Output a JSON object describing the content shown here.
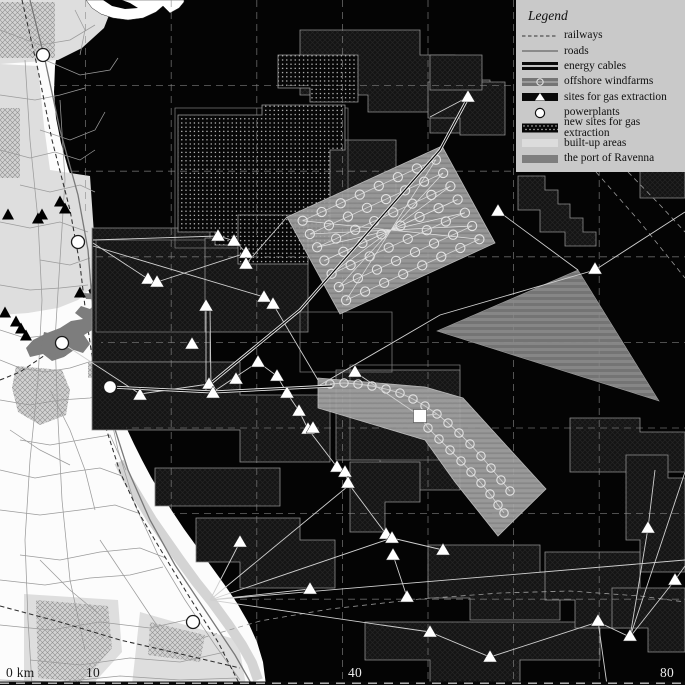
{
  "title": "Map of the Ravenna coast and offshore energy infrastructure",
  "colors": {
    "sea": "#040404",
    "land": "#fcfcfc",
    "builtup": "#dedede",
    "port": "#7d7d7d",
    "legend_bg": "#c9c9c9",
    "marker_white": "#ffffff",
    "concession_stroke": "#8e8e8e",
    "grid": "#8a8a8a",
    "road": "#9b9b9b",
    "railway": "#2e2e2e",
    "cable": "#d0d0d0",
    "scale_dark": "#1d1d1d",
    "scale_light": "#ececec"
  },
  "legend": {
    "title": "Legend",
    "x": 516,
    "y": 0,
    "width": 169,
    "height": 172,
    "items": [
      {
        "id": "railways",
        "symbol": "railway-line",
        "label": "railways"
      },
      {
        "id": "roads",
        "symbol": "road-line",
        "label": "roads"
      },
      {
        "id": "energy-cables",
        "symbol": "cable-swatch",
        "label": "energy cables"
      },
      {
        "id": "offshore-windfarms",
        "symbol": "windfarm-swatch",
        "label": "offshore windfarms"
      },
      {
        "id": "gas-sites",
        "symbol": "gas-swatch",
        "label": "sites for gas extraction"
      },
      {
        "id": "powerplants",
        "symbol": "powerplant-circle",
        "label": "powerplants"
      },
      {
        "id": "new-gas-sites",
        "symbol": "newgas-swatch",
        "label": "new sites for gas extraction"
      },
      {
        "id": "built-up",
        "symbol": "builtup-swatch",
        "label": "built-up areas"
      },
      {
        "id": "port-ravenna",
        "symbol": "port-swatch",
        "label": "the port of Ravenna"
      }
    ]
  },
  "scale": {
    "labels": [
      {
        "text": "0 km",
        "x": 6,
        "y": 665,
        "tone": "dark"
      },
      {
        "text": "10",
        "x": 86,
        "y": 665,
        "tone": "dark"
      },
      {
        "text": "40",
        "x": 348,
        "y": 665,
        "tone": "light"
      },
      {
        "text": "80",
        "x": 660,
        "y": 665,
        "tone": "light"
      }
    ]
  },
  "map": {
    "grid_spacing": 85.6,
    "coast": "75,0 66,20 59,42 55,66 54,92 56,118 61,143 68,168 77,193 86,215 92,233 94,246 91,262 88,276 88,289 92,300 96,312 99,326 101,342 104,360 108,377 113,393 119,410 126,427 134,444 142,460 151,477 161,494 172,511 184,529 197,547 211,566 224,584 237,603 248,622 257,642 263,662 266,685",
    "peninsula": "86,0 92,8 101,14 113,18 128,20 143,18 156,12 163,6 170,13 179,8 184,2 184,0",
    "peninsula_notch": "103,0 112,6 125,9 138,8 130,3 122,0",
    "builtup": [
      "0,0 115,0 104,28 82,48 58,60 0,64",
      "0,64 38,66 44,126 50,170 90,176 94,234 96,262 91,288 78,300 58,308 28,313 0,315",
      "24,594 118,600 122,652 92,685 24,685",
      "140,612 238,640 246,685 132,685"
    ],
    "builtup_coast_strip": "119,462 128,480 140,500 152,520 166,540 180,560 196,582 212,602 228,624 242,645 252,663 258,680",
    "cityhatch": [
      "0,2 55,2 55,58 0,58",
      "0,108 20,108 20,178 0,178",
      "16,366 62,370 70,390 66,415 40,425 18,412 12,388",
      "36,600 108,606 112,648 82,682 38,678",
      "88,362 112,362 112,378 88,378",
      "118,359 138,359 138,373 118,373",
      "150,622 205,635 200,662 148,655"
    ],
    "port": [
      "109,294 97,302 90,309 81,306 75,313 83,319 71,321 60,328 47,333 33,340 26,348 30,357 43,354 52,361 64,357 74,350 83,353 90,344 84,335 94,329 100,320 105,311 111,303",
      "44,332 70,338 66,356 40,352",
      "84,293 112,295 112,300 86,299"
    ],
    "roads_main": "30,0 45,60 60,130 78,195 88,250 92,300 100,360 112,420 128,470 150,520 175,565 205,610 235,655 252,685",
    "roads": [
      "0,30 40,45 70,40 95,25",
      "45,60 80,75 110,70 118,58",
      "0,95 35,100 60,95 85,88",
      "40,130 70,140 95,130 105,112",
      "0,150 30,158 55,152 80,160 95,150",
      "20,185 50,192 80,185 95,192",
      "0,222 30,228 60,222 88,232",
      "40,260 70,265 90,258",
      "0,285 30,290 60,288 88,285",
      "0,330 25,338 50,335 70,330",
      "0,360 20,368 45,372 70,368 95,360 110,370",
      "0,400 30,405 60,400 90,398 110,392",
      "20,440 50,445 80,440 110,435 126,470",
      "0,470 35,478 70,472 100,468 122,476",
      "0,510 40,515 80,510 115,505 138,513",
      "20,555 60,560 100,552 140,548 166,558",
      "0,580 45,585 90,578 130,575 163,567",
      "0,625 50,630 100,622 150,628 195,618",
      "30,660 80,665 130,658 180,662 225,652",
      "0,680 60,682 120,676 180,680 238,678",
      "25,60 30,140 38,220 42,300 38,380 30,460 25,540 28,620 32,685",
      "60,100 65,180 60,260 55,340 58,420 62,500 70,580 85,650",
      "95,330 105,390 118,450 135,505 158,555 185,600 215,645 240,680",
      "75,10 85,30 80,55",
      "50,390 70,430 85,470 95,510",
      "10,430 40,450 70,465",
      "100,540 120,570 140,600 160,630",
      "40,560 70,590 100,615"
    ],
    "railways": [
      "22,0 38,70 52,140 70,210 80,265 86,315 94,370 105,425 120,472 140,515 162,552 190,598 218,642 240,685",
      "0,606 60,622 120,640 185,655 240,668",
      "86,315 60,345 20,372 0,380"
    ],
    "concessions": [
      "300,30 420,30 420,55 455,55 455,80 490,80 490,133 430,133 430,112 368,112 368,95 300,95",
      "310,140 396,140 396,214 310,214",
      "92,228 210,228 210,362 92,362",
      "92,362 240,362 240,395 330,395 330,462 240,462 240,430 92,430",
      "336,370 460,370 460,490 380,490 380,460 336,460",
      "518,176 545,176 545,190 558,190 558,204 570,204 570,218 583,218 583,232 596,232 596,246 565,246 565,232 540,232 540,210 518,210",
      "612,62 685,62 685,135 640,135 640,112 612,112",
      "640,142 685,142 685,198 640,198",
      "570,418 640,418 640,432 685,432 685,472 570,472",
      "626,455 668,455 668,478 685,478 685,572 640,572 640,540 626,540",
      "196,518 300,518 300,540 335,540 335,588 240,588 240,562 196,562",
      "155,468 280,468 280,506 155,506",
      "365,622 600,622 600,660 520,660 520,685 430,685 430,660 365,660",
      "428,545 540,545 540,572 560,572 560,620 470,620 470,598 428,598",
      "545,552 640,552 640,628 575,628 575,600 545,600",
      "612,588 685,588 685,652 648,652 648,628 612,628",
      "350,462 420,462 420,502 385,502 385,532 350,532",
      "205,238 308,238 308,332 205,332",
      "428,82 505,82 505,135 460,135 460,118 428,118",
      "430,55 482,55 482,90 430,90"
    ],
    "outline_zones": [
      "350,365 460,365 460,460 350,460",
      "96,240 205,240 205,332 96,332",
      "300,312 392,312 392,372 300,372",
      "175,108 348,108 348,248 175,248"
    ],
    "dotted_zones": [
      "178,115 262,115 262,105 345,105 345,150 330,150 330,245 215,245 215,232 178,232",
      "278,55 358,55 358,102 310,102 310,88 278,88",
      "238,215 308,215 308,264 238,264"
    ],
    "striped_triangle": "437,331 578,270 659,401",
    "windfarm_grid": {
      "corners": [
        [
          287,
          217
        ],
        [
          442,
          146
        ],
        [
          495,
          243
        ],
        [
          340,
          314
        ]
      ],
      "rows": 7,
      "cols": 8,
      "r": 4.6
    },
    "windfarm_band": {
      "outline": "318,378 425,387 463,398 546,489 498,536 455,482 425,440 318,408",
      "chain1": [
        [
          330,
          384
        ],
        [
          344,
          383
        ],
        [
          358,
          384
        ],
        [
          372,
          386
        ],
        [
          386,
          389
        ],
        [
          400,
          393
        ],
        [
          413,
          399
        ],
        [
          425,
          406
        ],
        [
          437,
          414
        ],
        [
          448,
          423
        ],
        [
          459,
          433
        ],
        [
          470,
          444
        ],
        [
          481,
          456
        ],
        [
          491,
          468
        ],
        [
          501,
          480
        ],
        [
          510,
          491
        ]
      ],
      "chain2": [
        [
          428,
          428
        ],
        [
          439,
          439
        ],
        [
          450,
          450
        ],
        [
          461,
          461
        ],
        [
          471,
          472
        ],
        [
          481,
          483
        ],
        [
          490,
          494
        ],
        [
          498,
          505
        ],
        [
          504,
          513
        ]
      ],
      "r": 4.2
    },
    "sea_dashed_routes": [
      "195,640 260,621 330,609 420,599 500,593 570,591 640,596 685,602",
      "628,172 660,205 685,232",
      "596,172 640,222 685,278"
    ],
    "cables": [
      "93,240 218,236 235,241 247,254 246,264",
      "93,243 148,279 157,282",
      "93,246 264,297 273,304 318,380",
      "157,282 246,253",
      "206,307 206,390",
      "210,307 211,390",
      "62,343 140,394 209,384",
      "213,392 258,362",
      "258,362 277,376 287,393 299,411 308,429 337,467 345,472 348,483 386,534 392,538",
      "392,538 443,550",
      "393,555 407,597",
      "210,600 347,487",
      "210,600 240,542",
      "210,600 310,589",
      "210,600 392,538",
      "210,600 430,632",
      "210,600 685,560",
      "630,637 675,580 685,566",
      "630,637 685,472",
      "630,637 598,622 490,657 430,632",
      "630,637 648,528 655,470",
      "598,621 607,685",
      "468,97 430,117",
      "498,211 578,270",
      "320,385 440,315 595,270 685,212",
      "420,416 437,414",
      "420,416 428,428",
      "355,372 420,416",
      "246,264 287,217"
    ],
    "cables_thick": [
      "110,387 213,392 332,386",
      "210,384 300,310 440,150 468,98"
    ],
    "triangles_sea": [
      [
        218,
        236
      ],
      [
        234,
        241
      ],
      [
        246,
        253
      ],
      [
        246,
        264
      ],
      [
        148,
        279
      ],
      [
        157,
        282
      ],
      [
        264,
        297
      ],
      [
        273,
        304
      ],
      [
        206,
        306
      ],
      [
        192,
        344
      ],
      [
        209,
        384
      ],
      [
        236,
        379
      ],
      [
        140,
        395
      ],
      [
        213,
        393
      ],
      [
        258,
        362
      ],
      [
        277,
        376
      ],
      [
        287,
        393
      ],
      [
        299,
        411
      ],
      [
        308,
        429
      ],
      [
        355,
        372
      ],
      [
        313,
        428
      ],
      [
        337,
        467
      ],
      [
        345,
        472
      ],
      [
        348,
        483
      ],
      [
        240,
        542
      ],
      [
        310,
        589
      ],
      [
        386,
        534
      ],
      [
        392,
        538
      ],
      [
        393,
        555
      ],
      [
        443,
        550
      ],
      [
        407,
        597
      ],
      [
        430,
        632
      ],
      [
        490,
        657
      ],
      [
        598,
        621
      ],
      [
        630,
        636
      ],
      [
        675,
        580
      ],
      [
        648,
        528
      ],
      [
        595,
        269
      ],
      [
        468,
        97
      ],
      [
        498,
        211
      ]
    ],
    "triangles_land": [
      [
        60,
        202
      ],
      [
        65,
        209
      ],
      [
        42,
        215
      ],
      [
        8,
        215
      ],
      [
        38,
        219
      ],
      [
        80,
        293
      ],
      [
        5,
        313
      ],
      [
        16,
        322
      ],
      [
        21,
        329
      ],
      [
        26,
        336
      ]
    ],
    "powerplants": [
      [
        43,
        55
      ],
      [
        78,
        242
      ],
      [
        62,
        343
      ],
      [
        110,
        387
      ],
      [
        193,
        622
      ]
    ],
    "squares": [
      [
        420,
        416
      ]
    ]
  }
}
